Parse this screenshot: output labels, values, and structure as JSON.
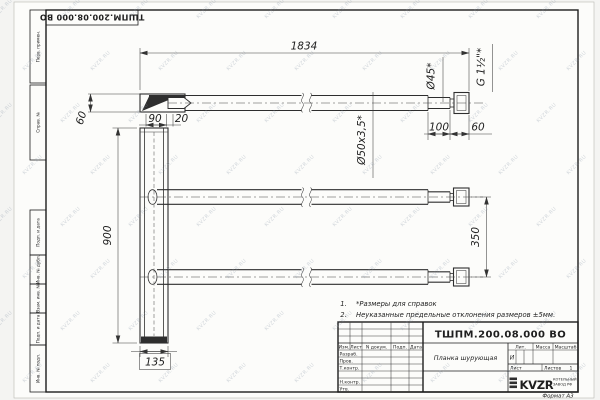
{
  "sheet": {
    "designation_stamp": "ТШПМ.200.08.000 ВО",
    "format": "Формат А3",
    "watermark": "KVZR.RU"
  },
  "margin": {
    "perv_primen": "Перв. примен.",
    "sprav_no": "Справ. №",
    "podp_data_1": "Подп. и дата",
    "inv_dubl": "Инв. № дубл.",
    "vzam_inv": "Взам. инв. №",
    "podp_data_2": "Подп. и дата",
    "inv_podl": "Инв. № подл."
  },
  "dims": {
    "total_length": "1834",
    "plate_offset": "60",
    "plate_width_top": "90",
    "plate_gap": "20",
    "pipe_spec": "Ø50x3,5*",
    "end_dia": "Ø45*",
    "thread": "G 1½\"*",
    "end_length": "100",
    "thread_length": "60",
    "plate_height": "900",
    "pipe_spacing": "350",
    "plate_width": "135"
  },
  "notes": {
    "n1_no": "1.",
    "n1_text": "*Размеры для справок",
    "n2_no": "2.",
    "n2_text": "Неуказанные предельные отклонения размеров ±5мм."
  },
  "title_block": {
    "designation": "ТШПМ.200.08.000 ВО",
    "part_name": "Планка шурующая",
    "col_izm": "Изм.",
    "col_list": "Лист",
    "col_doc": "N докум.",
    "col_podp": "Подп.",
    "col_data": "Дата",
    "row_razrab": "Разраб.",
    "row_prov": "Пров.",
    "row_tkontr": "Т.контр.",
    "row_nkontr": "Н.контр.",
    "row_utv": "Утв.",
    "lit_header": "Лит.",
    "lit_value": "И",
    "massa_header": "Масса",
    "masshtab_header": "Масштаб",
    "list_label": "Лист",
    "listov_label": "Листов",
    "listov_value": "1",
    "logo_text": "KVZR",
    "logo_sub1": "КОТЕЛЬНЫЙ",
    "logo_sub2": "ЗАВОД РФ"
  }
}
